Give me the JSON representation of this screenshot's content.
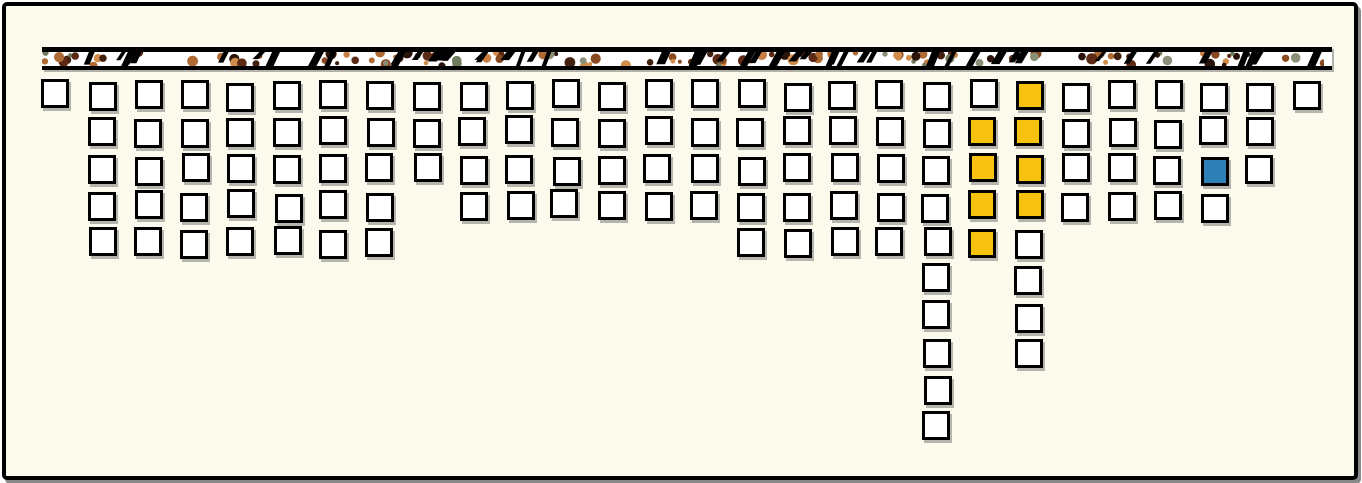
{
  "page": {
    "background_color": "#FCFAEC",
    "frame_border_color": "#000000"
  },
  "strip": {
    "fill": "#FFFFFF",
    "border_color": "#000000",
    "slash_color": "#000000",
    "dot_colors": [
      "#b06a33",
      "#8a4a21",
      "#c87f45",
      "#41200e",
      "#2a140a",
      "#6f7d5e",
      "#8a9077",
      "#5c2a14",
      "#d08c4a"
    ],
    "num_dots": 120,
    "num_slashes": 52
  },
  "chart_data": {
    "type": "waffle",
    "orientation": "columns hang downward from top band",
    "num_columns": 28,
    "max_column_depth": 10,
    "total_squares": 126,
    "square_fill": "#FFFFFF",
    "square_border": "#000000",
    "highlight_colors": {
      "yellow": "#F8C110",
      "blue": "#2F7FB9"
    },
    "column_counts": [
      1,
      5,
      5,
      5,
      5,
      5,
      5,
      5,
      3,
      4,
      4,
      4,
      4,
      4,
      4,
      5,
      5,
      5,
      5,
      10,
      5,
      8,
      4,
      4,
      4,
      4,
      3,
      1
    ],
    "highlight_cells": [
      {
        "col": 22,
        "row": 1,
        "color": "yellow"
      },
      {
        "col": 21,
        "row": 2,
        "color": "yellow"
      },
      {
        "col": 22,
        "row": 2,
        "color": "yellow"
      },
      {
        "col": 21,
        "row": 3,
        "color": "yellow"
      },
      {
        "col": 22,
        "row": 3,
        "color": "yellow"
      },
      {
        "col": 26,
        "row": 3,
        "color": "blue"
      },
      {
        "col": 21,
        "row": 4,
        "color": "yellow"
      },
      {
        "col": 22,
        "row": 4,
        "color": "yellow"
      },
      {
        "col": 21,
        "row": 5,
        "color": "yellow"
      }
    ]
  }
}
